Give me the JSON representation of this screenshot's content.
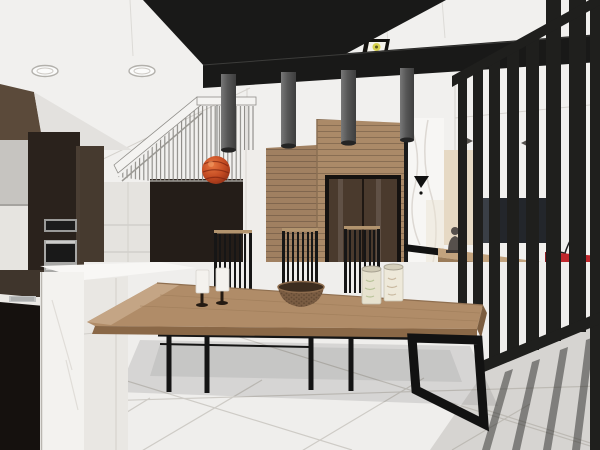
{
  "scene": {
    "type": "3d-interior-render",
    "style": "sketchup-like architectural visualization",
    "room": "open-plan kitchen, dining and living room with staircase"
  },
  "palette": {
    "ceiling_white": "#f1f0ee",
    "beam_black": "#191918",
    "pendant_gray": "#5a5a5a",
    "wood_wall": "#ab8a68",
    "wood_wall_left": "#a08061",
    "door_brown": "#4a3a2d",
    "marble_white": "#f7f6f4",
    "screen_black": "#1f1f1d",
    "table_wood": "#b08c68",
    "table_edge": "#c4a585",
    "sofa_red": "#c1272d",
    "floor_tile": "#efeeec",
    "island_white": "#f3f2ef",
    "cabinet_dark": "#2a221c",
    "stair_wall": "#241d18",
    "accent_sphere": "#c24a22",
    "console_wood": "#9a7b59",
    "platform_wood": "#c9a87e",
    "spotlight_yellow": "#d8d24e",
    "chair_black": "#161616",
    "statue_gray": "#56504c"
  },
  "objects": {
    "pendant_cylinders": {
      "label": "cylinder pendant lights",
      "count": 4
    },
    "recessed_oval_lights": {
      "label": "oval recessed downlights",
      "count": 2
    },
    "square_spotlights": {
      "label": "square recessed spotlights",
      "count": 2
    },
    "diamond_downlights": {
      "label": "small recessed downlights",
      "count": 3
    },
    "sphere_lamp": {
      "label": "orange sphere pendant lamp",
      "count": 1
    },
    "dining_chairs": {
      "label": "slat-back dining chairs",
      "count": 3
    },
    "stools": {
      "label": "black stool legs under table",
      "count": 4
    },
    "candles": {
      "label": "white candles on stands",
      "count": 2
    },
    "bowl": {
      "label": "woven wooden bowl",
      "count": 1
    },
    "canisters": {
      "label": "cream storage canisters",
      "count": 2
    },
    "ovens": {
      "label": "built-in stainless ovens",
      "count": 2
    },
    "screen_bars": {
      "label": "black partition slats",
      "count": 8
    },
    "tv": {
      "label": "wall mounted tv",
      "count": 1
    },
    "statue": {
      "label": "small gray statue on console",
      "count": 1
    },
    "sofa": {
      "label": "red sofa",
      "count": 1
    }
  }
}
